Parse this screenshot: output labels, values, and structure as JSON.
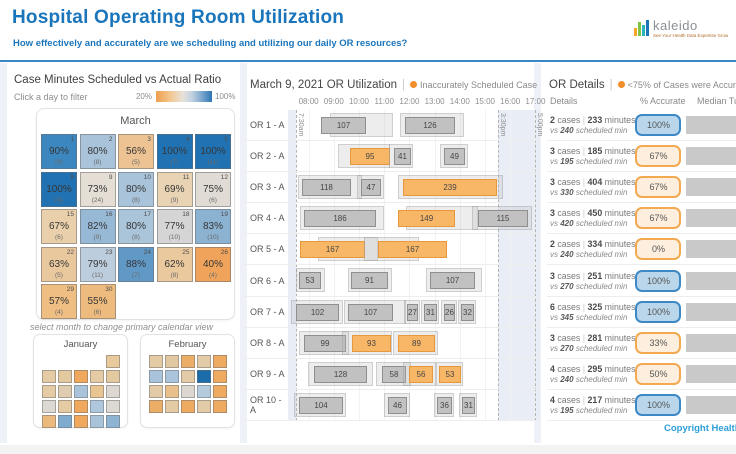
{
  "header": {
    "title": "Hospital Operating Room Utilization",
    "subtitle": "How effectively and accurately are we scheduling and utilizing our daily OR resources?",
    "logo1": {
      "name": "kaleido",
      "tagline": "See Your Health Data Expertise Grow"
    },
    "logo2": {
      "name": "He"
    }
  },
  "left_panel": {
    "title": "Case Minutes Scheduled vs Actual Ratio",
    "hint": "Click a day to filter",
    "legend": {
      "min": "20%",
      "max": "100%"
    },
    "month_title": "March",
    "note": "select month to change primary calendar view",
    "days": [
      {
        "day": 1,
        "pct": "90%",
        "count": "(9)",
        "color": "#3d87c0"
      },
      {
        "day": 2,
        "pct": "80%",
        "count": "(8)",
        "color": "#a8c3da"
      },
      {
        "day": 3,
        "pct": "56%",
        "count": "(5)",
        "color": "#edc393"
      },
      {
        "day": 4,
        "pct": "100%",
        "count": "(7)",
        "color": "#2172b2"
      },
      {
        "day": 5,
        "pct": "100%",
        "count": "(11)",
        "color": "#2172b2"
      },
      {
        "day": 8,
        "pct": "100%",
        "count": "(4)",
        "color": "#2172b2"
      },
      {
        "day": 9,
        "pct": "73%",
        "count": "(24)",
        "color": "#e5ded4"
      },
      {
        "day": 10,
        "pct": "80%",
        "count": "(8)",
        "color": "#a8c3da"
      },
      {
        "day": 11,
        "pct": "69%",
        "count": "(9)",
        "color": "#e8d3b4"
      },
      {
        "day": 12,
        "pct": "75%",
        "count": "(6)",
        "color": "#e0dbd5"
      },
      {
        "day": 15,
        "pct": "67%",
        "count": "(6)",
        "color": "#e9d0ab"
      },
      {
        "day": 16,
        "pct": "82%",
        "count": "(9)",
        "color": "#97b9d6"
      },
      {
        "day": 17,
        "pct": "80%",
        "count": "(8)",
        "color": "#aac4da"
      },
      {
        "day": 18,
        "pct": "77%",
        "count": "(10)",
        "color": "#d4d5d4"
      },
      {
        "day": 19,
        "pct": "83%",
        "count": "(10)",
        "color": "#8cb2d2"
      },
      {
        "day": 22,
        "pct": "63%",
        "count": "(5)",
        "color": "#eac89e"
      },
      {
        "day": 23,
        "pct": "79%",
        "count": "(11)",
        "color": "#bccddd"
      },
      {
        "day": 24,
        "pct": "88%",
        "count": "(7)",
        "color": "#6098c6"
      },
      {
        "day": 25,
        "pct": "62%",
        "count": "(8)",
        "color": "#ebc99f"
      },
      {
        "day": 26,
        "pct": "40%",
        "count": "(4)",
        "color": "#f0a45b"
      },
      {
        "day": 29,
        "pct": "57%",
        "count": "(4)",
        "color": "#eebe83"
      },
      {
        "day": 30,
        "pct": "55%",
        "count": "(6)",
        "color": "#eebb7f"
      }
    ],
    "mini_months": [
      {
        "id": "january",
        "title": "January",
        "cells": [
          null,
          null,
          null,
          null,
          "#e7c99b",
          "#e4cba3",
          "#e3c9a0",
          "#f0a95c",
          "#e4cba3",
          "#e3c9a0",
          "#e4cba3",
          "#e0cdb1",
          "#a9c4da",
          "#e8c591",
          "#dcd7d1",
          "#dcd8d2",
          "#e4cba3",
          "#f0a95c",
          "#aec7dc",
          "#dcd8d2",
          "#ecb97d",
          "#7fabce",
          "#f0a95c",
          "#a9c4da",
          "#8fb4d3"
        ]
      },
      {
        "id": "february",
        "title": "February",
        "cells": [
          "#e4cba3",
          "#e2c8a0",
          "#ecae66",
          "#e2cba6",
          "#eeaa60",
          "#a9c4da",
          "#aac5db",
          "#e2cba6",
          "#1b6cab",
          "#eeaa60",
          "#e2cba6",
          "#e9c08b",
          "#dcd7d1",
          "#b4cadd",
          "#eeaa60",
          "#ecae66",
          "#e4cba3",
          "#eeaa60",
          "#e2cba6",
          "#eeaa60"
        ]
      }
    ]
  },
  "gantt": {
    "title": "March 9, 2021 OR Utilization",
    "legend_label": "Inaccurately Scheduled Case",
    "hours": [
      "08:00",
      "09:00",
      "10:00",
      "11:00",
      "12:00",
      "13:00",
      "14:00",
      "15:00",
      "16:00",
      "17:00"
    ],
    "markers": [
      {
        "label": "7:30am",
        "off": 8
      },
      {
        "label": "3:30pm",
        "off": 210
      },
      {
        "label": "5:00pm",
        "off": 247
      }
    ],
    "rows": [
      {
        "label": "OR 1 - A",
        "cases": [
          {
            "v": 107,
            "off": 33,
            "w": 45,
            "orange": false,
            "so": 42,
            "sw": 63
          },
          {
            "v": 126,
            "off": 117,
            "w": 50,
            "orange": false,
            "so": 112,
            "sw": 64
          }
        ]
      },
      {
        "label": "OR 2 - A",
        "cases": [
          {
            "v": 95,
            "off": 62,
            "w": 40,
            "orange": true,
            "so": 50,
            "sw": 52
          },
          {
            "v": 41,
            "off": 106,
            "w": 17,
            "orange": false,
            "so": 101,
            "sw": 24
          },
          {
            "v": 49,
            "off": 156,
            "w": 21,
            "orange": false,
            "so": 152,
            "sw": 28
          }
        ]
      },
      {
        "label": "OR 3 - A",
        "cases": [
          {
            "v": 118,
            "off": 14,
            "w": 49,
            "orange": false,
            "so": 10,
            "sw": 64
          },
          {
            "v": 47,
            "off": 73,
            "w": 20,
            "orange": false,
            "so": 69,
            "sw": 27
          },
          {
            "v": 239,
            "off": 115,
            "w": 94,
            "orange": true,
            "so": 110,
            "sw": 105
          }
        ]
      },
      {
        "label": "OR 4 - A",
        "cases": [
          {
            "v": 186,
            "off": 16,
            "w": 72,
            "orange": false,
            "so": 12,
            "sw": 84
          },
          {
            "v": 149,
            "off": 110,
            "w": 57,
            "orange": true,
            "so": 118,
            "sw": 72
          },
          {
            "v": 115,
            "off": 190,
            "w": 50,
            "orange": false,
            "so": 184,
            "sw": 60
          }
        ]
      },
      {
        "label": "OR 5 - A",
        "cases": [
          {
            "v": 167,
            "off": 12,
            "w": 65,
            "orange": true,
            "so": 30,
            "sw": 60
          },
          {
            "v": 167,
            "off": 90,
            "w": 69,
            "orange": true,
            "so": 76,
            "sw": 55
          }
        ]
      },
      {
        "label": "OR 6 - A",
        "cases": [
          {
            "v": 53,
            "off": 11,
            "w": 22,
            "orange": false,
            "so": 8,
            "sw": 29
          },
          {
            "v": 91,
            "off": 63,
            "w": 37,
            "orange": false,
            "so": 60,
            "sw": 44
          },
          {
            "v": 107,
            "off": 142,
            "w": 45,
            "orange": false,
            "so": 138,
            "sw": 56
          }
        ]
      },
      {
        "label": "OR 7 - A",
        "cases": [
          {
            "v": 102,
            "off": 8,
            "w": 43,
            "orange": false,
            "so": 3,
            "sw": 52
          },
          {
            "v": 107,
            "off": 60,
            "w": 45,
            "orange": false,
            "so": 56,
            "sw": 62
          },
          {
            "v": 27,
            "off": 119,
            "w": 11,
            "orange": false,
            "so": 116,
            "sw": 16
          },
          {
            "v": 31,
            "off": 136,
            "w": 13,
            "orange": false,
            "so": 133,
            "sw": 18
          },
          {
            "v": 26,
            "off": 156,
            "w": 11,
            "orange": false,
            "so": 153,
            "sw": 16
          },
          {
            "v": 32,
            "off": 173,
            "w": 13,
            "orange": false,
            "so": 170,
            "sw": 18
          }
        ]
      },
      {
        "label": "OR 8 - A",
        "cases": [
          {
            "v": 99,
            "off": 16,
            "w": 42,
            "orange": false,
            "so": 11,
            "sw": 50
          },
          {
            "v": 93,
            "off": 64,
            "w": 39,
            "orange": true,
            "so": 54,
            "sw": 50
          },
          {
            "v": 89,
            "off": 110,
            "w": 37,
            "orange": true,
            "so": 105,
            "sw": 45
          }
        ]
      },
      {
        "label": "OR 9 - A",
        "cases": [
          {
            "v": 128,
            "off": 26,
            "w": 53,
            "orange": false,
            "so": 20,
            "sw": 65
          },
          {
            "v": 58,
            "off": 94,
            "w": 24,
            "orange": false,
            "so": 88,
            "sw": 35
          },
          {
            "v": 56,
            "off": 121,
            "w": 24,
            "orange": true,
            "so": 115,
            "sw": 33
          },
          {
            "v": 53,
            "off": 151,
            "w": 22,
            "orange": true,
            "so": 148,
            "sw": 27
          }
        ]
      },
      {
        "label": "OR 10 - A",
        "cases": [
          {
            "v": 104,
            "off": 11,
            "w": 44,
            "orange": false,
            "so": 6,
            "sw": 52
          },
          {
            "v": 46,
            "off": 100,
            "w": 19,
            "orange": false,
            "so": 96,
            "sw": 26
          },
          {
            "v": 36,
            "off": 149,
            "w": 15,
            "orange": false,
            "so": 146,
            "sw": 20
          },
          {
            "v": 31,
            "off": 174,
            "w": 13,
            "orange": false,
            "so": 171,
            "sw": 18
          }
        ]
      }
    ]
  },
  "details": {
    "title": "OR Details",
    "legend_label": "<75% of Cases were Accurately Scheduled",
    "columns": [
      "Details",
      "% Accurate",
      "Median Turn"
    ],
    "rows": [
      {
        "cases": "2",
        "minutes": "233",
        "scheduled": "240",
        "accuracy": "100%",
        "status": "good",
        "bar_w": 55
      },
      {
        "cases": "3",
        "minutes": "185",
        "scheduled": "195",
        "accuracy": "67%",
        "status": "bad",
        "bar_w": 55
      },
      {
        "cases": "3",
        "minutes": "404",
        "scheduled": "330",
        "accuracy": "67%",
        "status": "bad",
        "bar_w": 55
      },
      {
        "cases": "3",
        "minutes": "450",
        "scheduled": "420",
        "accuracy": "67%",
        "status": "bad",
        "bar_w": 55
      },
      {
        "cases": "2",
        "minutes": "334",
        "scheduled": "240",
        "accuracy": "0%",
        "status": "bad",
        "bar_w": 55
      },
      {
        "cases": "3",
        "minutes": "251",
        "scheduled": "270",
        "accuracy": "100%",
        "status": "good",
        "bar_w": 55
      },
      {
        "cases": "6",
        "minutes": "325",
        "scheduled": "345",
        "accuracy": "100%",
        "status": "good",
        "bar_w": 55
      },
      {
        "cases": "3",
        "minutes": "281",
        "scheduled": "270",
        "accuracy": "33%",
        "status": "bad",
        "bar_w": 55
      },
      {
        "cases": "4",
        "minutes": "295",
        "scheduled": "240",
        "accuracy": "50%",
        "status": "bad",
        "bar_w": 55
      },
      {
        "cases": "4",
        "minutes": "217",
        "scheduled": "195",
        "accuracy": "100%",
        "status": "good",
        "bar_w": 55
      }
    ]
  },
  "footer": {
    "copyright": "Copyright HealthD"
  }
}
